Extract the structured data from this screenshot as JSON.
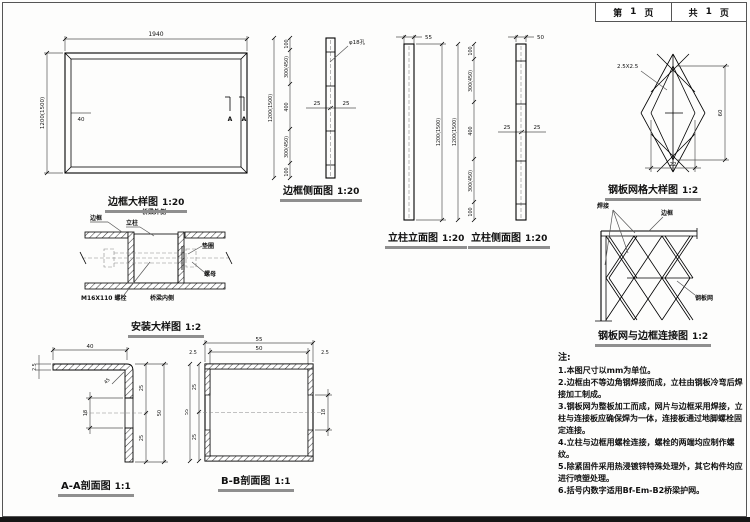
{
  "sheet": {
    "page_cell": {
      "prefix": "第",
      "number": "1",
      "suffix": "页"
    },
    "total_cell": {
      "prefix": "共",
      "number": "1",
      "suffix": "页"
    }
  },
  "frame_plan": {
    "caption": "边框大样图",
    "scale": "1:20",
    "dim_width": "1940",
    "dim_height": "1200(1500)",
    "dim_inset": "40",
    "section_label_1": "A",
    "section_label_2": "A"
  },
  "frame_side": {
    "caption": "边框侧面图",
    "scale": "1:20",
    "dim_overall": "1200(1500)",
    "seg1": "100",
    "seg2": "300(450)",
    "seg3": "400",
    "seg4": "300(450)",
    "seg5": "100",
    "dim_left": "25",
    "dim_right": "25",
    "hole_label": "φ18孔"
  },
  "post_front": {
    "caption": "立柱立面图",
    "scale": "1:20",
    "dim_width": "55",
    "dim_height": "1200(1500)"
  },
  "post_side": {
    "caption": "立柱侧面图",
    "scale": "1:20",
    "dim_width": "50",
    "dim_overall": "1200(1500)",
    "seg1": "100",
    "seg2": "300(450)",
    "seg3": "400",
    "seg4": "300(450)",
    "seg5": "100",
    "dim_left": "25",
    "dim_right": "25"
  },
  "mesh_detail": {
    "caption": "钢板网格大样图",
    "scale": "1:2",
    "strand_label": "2.5X2.5",
    "dim_height": "60",
    "dim_width": "22"
  },
  "install_detail": {
    "caption": "安装大样图",
    "scale": "1:2",
    "label_frame": "边框",
    "label_post": "立柱",
    "label_bridge_outer": "桥梁外侧",
    "label_washer": "垫圈",
    "label_nut": "螺母",
    "label_bolt": "M16X110 螺栓",
    "label_bridge_inner": "桥梁内侧"
  },
  "mesh_connection": {
    "caption": "钢板网与边框连接图",
    "scale": "1:2",
    "label_weld": "焊接",
    "label_frame": "边框",
    "label_mesh": "钢板网"
  },
  "section_aa": {
    "caption": "A-A剖面图",
    "scale": "1:1",
    "dim_top": "40",
    "dim_thk": "2.5",
    "dim_corner": "45",
    "dim_seg_top": "25",
    "dim_seg_bottom": "25",
    "dim_overall": "50",
    "dim_slot": "18"
  },
  "section_bb": {
    "caption": "B-B剖面图",
    "scale": "1:1",
    "dim_outer": "55",
    "dim_inner": "50",
    "dim_wall_left": "2.5",
    "dim_wall_right": "2.5",
    "dim_left_overall": "55",
    "dim_seg_top": "25",
    "dim_seg_bottom": "25",
    "dim_slot": "18"
  },
  "notes": {
    "title": "注:",
    "items": [
      "1.本图尺寸以mm为单位。",
      "2.边框由不等边角钢焊接而成，立柱由钢板冷弯后焊接加工制成。",
      "3.钢板网为整板加工而成，网片与边框采用焊接，立柱与连接板应确保焊为一体，连接板通过地脚螺栓固定连接。",
      "4.立柱与边框用螺栓连接，螺栓的两端均应制作螺纹。",
      "5.除紧固件采用热浸镀锌特殊处理外，其它构件均应进行喷塑处理。",
      "6.括号内数字适用Bf-Em-B2桥梁护网。"
    ]
  }
}
